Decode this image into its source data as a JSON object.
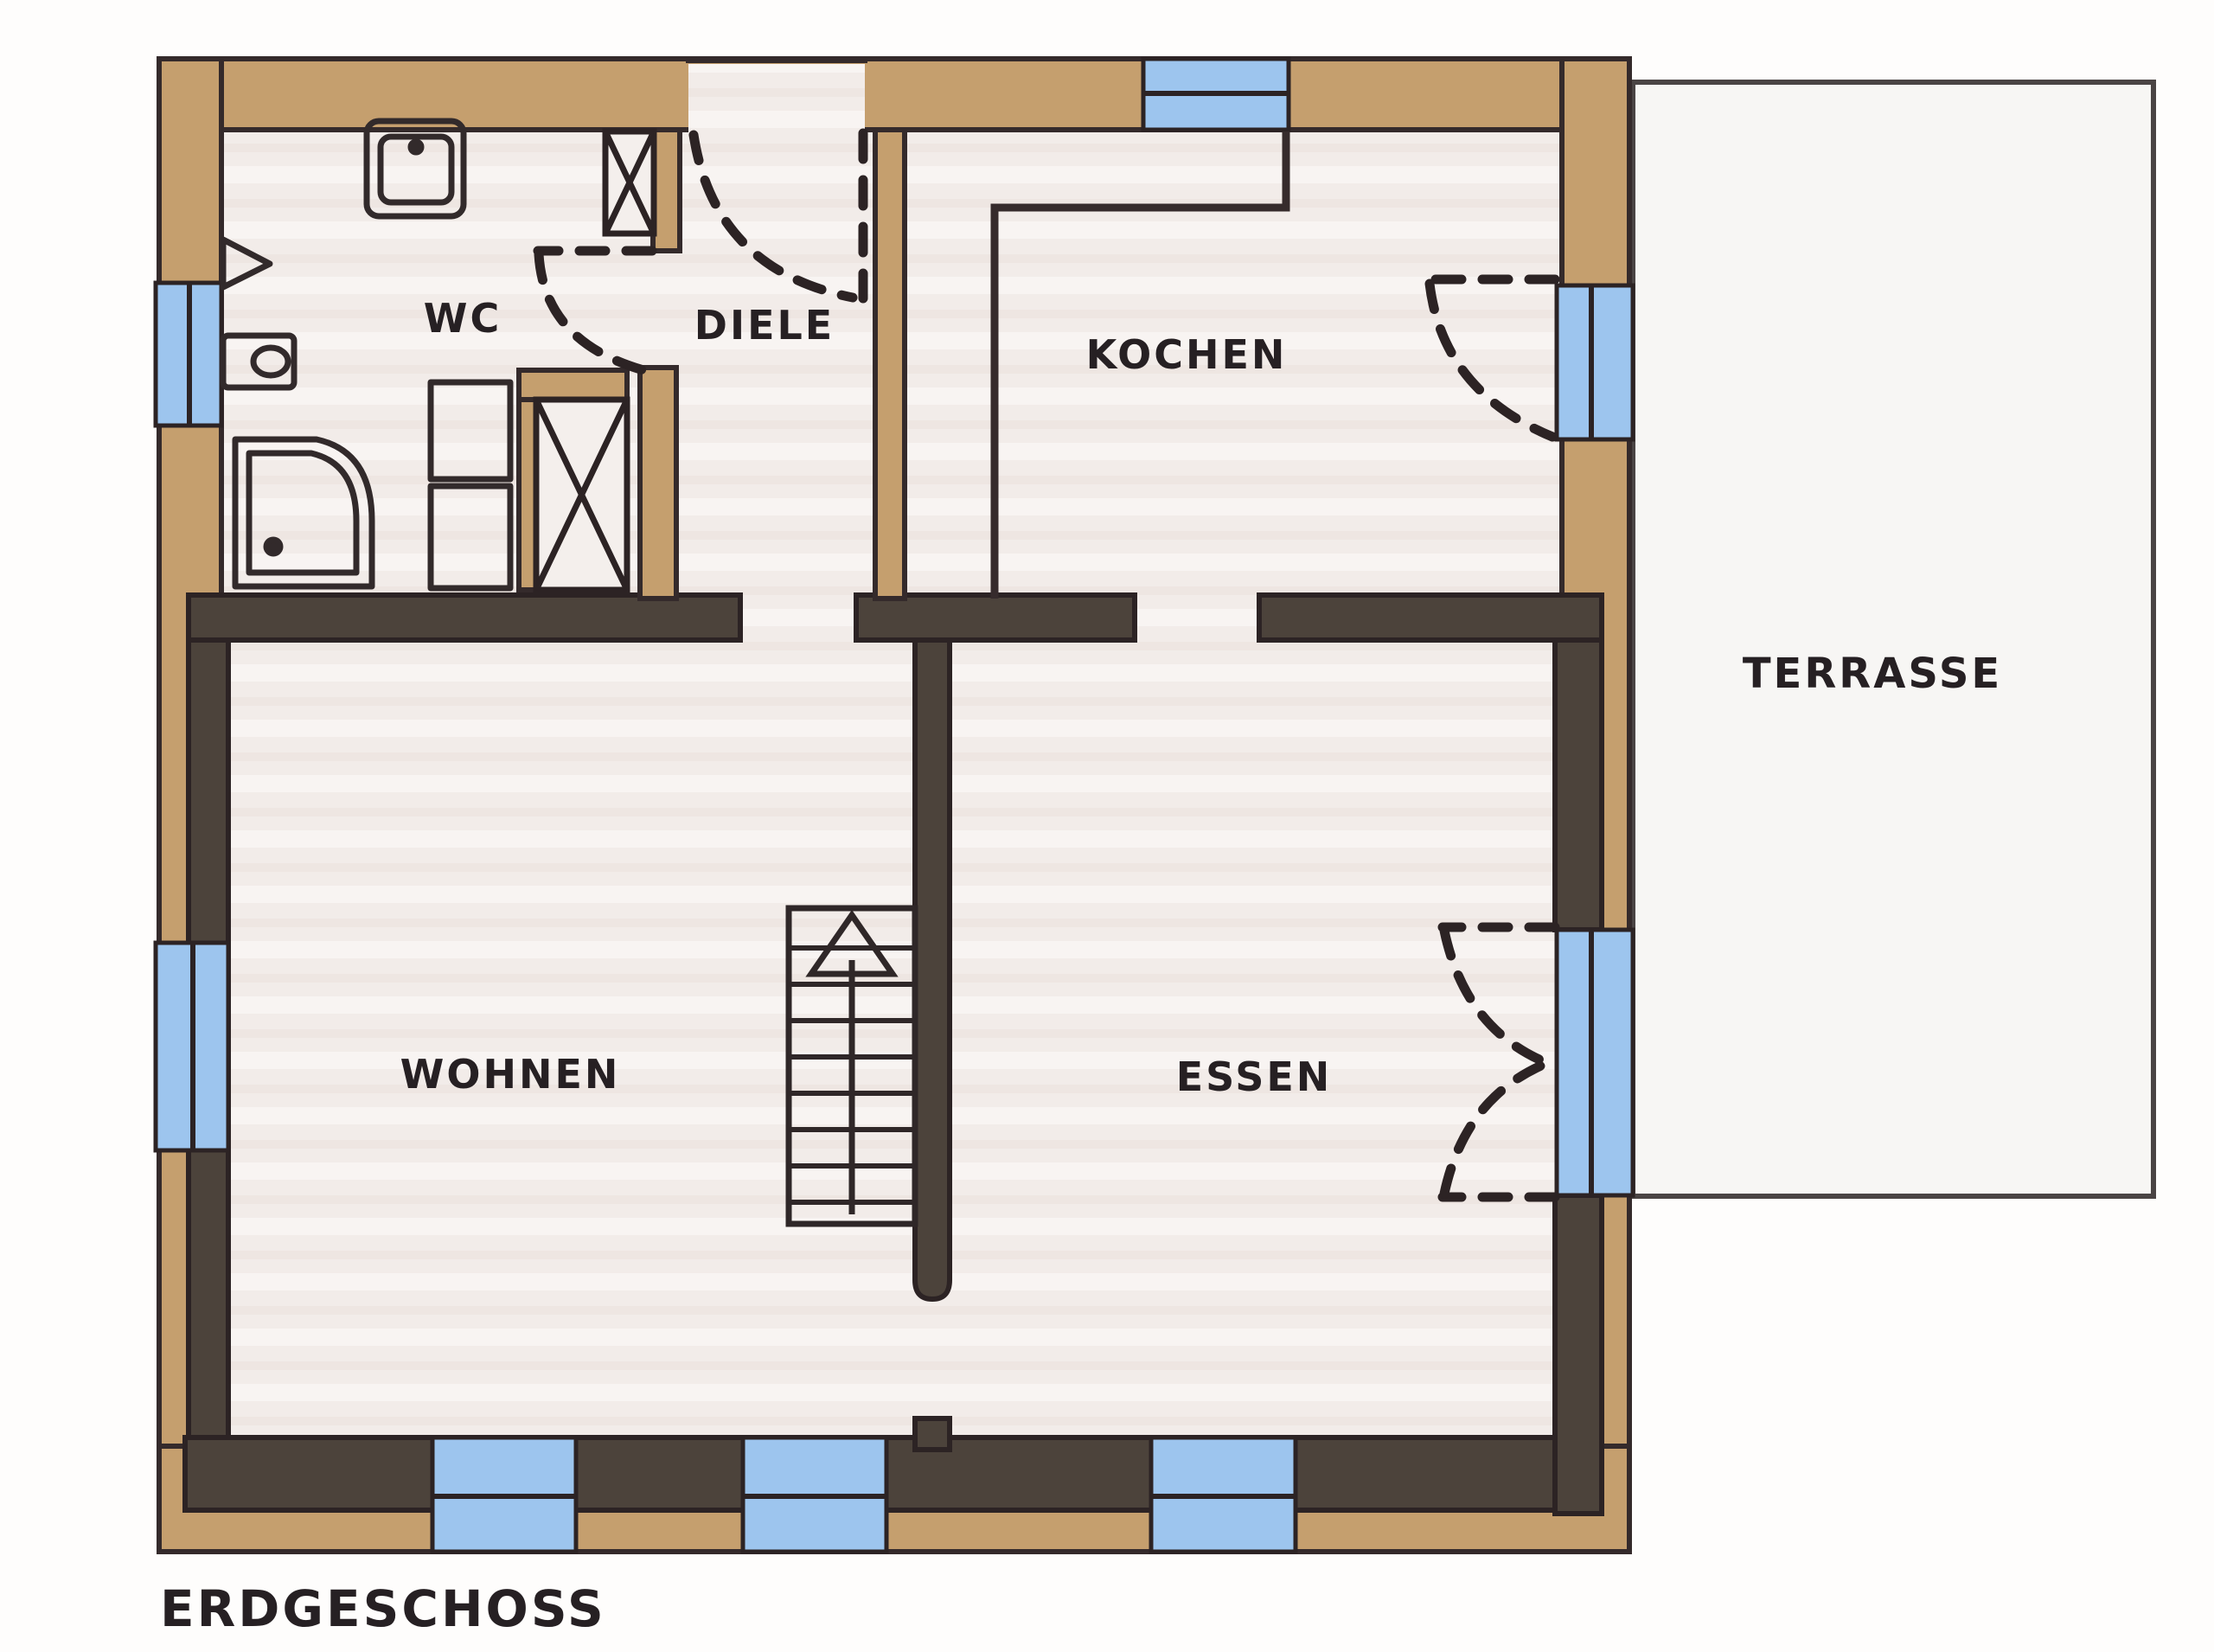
{
  "title": "ERDGESCHOSS",
  "rooms": {
    "wc": {
      "label": "WC"
    },
    "diele": {
      "label": "DIELE"
    },
    "kochen": {
      "label": "KOCHEN"
    },
    "wohnen": {
      "label": "WOHNEN"
    },
    "essen": {
      "label": "ESSEN"
    },
    "terrasse": {
      "label": "TERRASSE"
    }
  },
  "colors": {
    "paper": "#fefdfc",
    "floor": "#f2ece9",
    "floor_streak": "#f8f4f2",
    "terrace_fill": "#f7f6f4",
    "wall_tan": "#c59f6e",
    "wall_charcoal": "#4c433b",
    "outline": "#342a2b",
    "charcoal_outline": "#2c2324",
    "window_blue": "#9dc5ee",
    "ink": "#262023",
    "terrace_outline": "#4a4444"
  },
  "fixtures": [
    "sink-icon",
    "toilet-icon",
    "shower-icon",
    "wall-cupboard-icon",
    "shaft-x-icon",
    "shaft-x-icon",
    "kitchen-counter-icon",
    "stairs-up-icon",
    "door-swing-entrance",
    "door-swing-wc",
    "door-swing-kitchen-terrace",
    "double-door-swing-essen-terrace",
    "window-icon",
    "window-icon",
    "window-icon",
    "window-icon",
    "window-icon",
    "window-icon"
  ]
}
